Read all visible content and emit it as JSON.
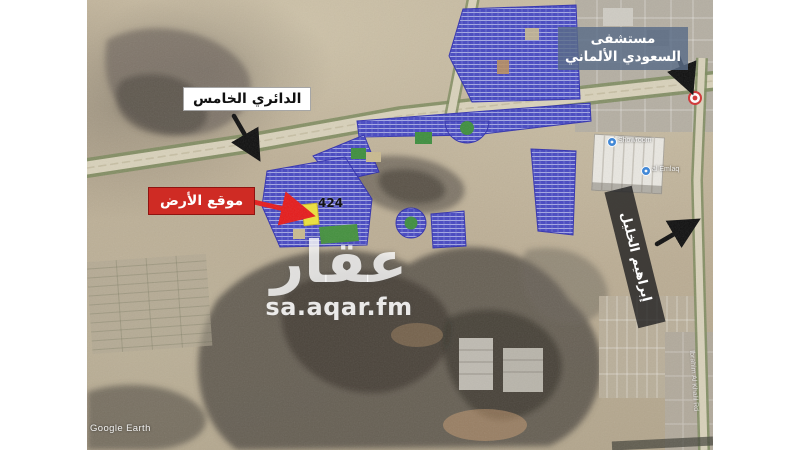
{
  "frame": {
    "background": "#ffffff"
  },
  "map": {
    "watermark": {
      "logo": "عقار",
      "site": "sa.aqar.fm"
    },
    "attribution": "Google Earth",
    "annotations": {
      "ring_road": "الدائري الخامس",
      "land_location": "موقع الأرض",
      "hospital": "مستشفى السعودي الألماني",
      "ibrahim_road": "إبراهيم الخليل",
      "plot_number": "424"
    },
    "pois": {
      "showroom": "Showroom",
      "emlaq": "al Emlaq",
      "street": "Ibrahim Al Khalil Rd"
    },
    "colors": {
      "annotation_red": "#cf2b24",
      "hospital_box": "#5a6c88",
      "subdivision_blue": "#4143c4",
      "road_green": "#7d8b5e",
      "highlight_yellow": "#ece23d"
    }
  }
}
